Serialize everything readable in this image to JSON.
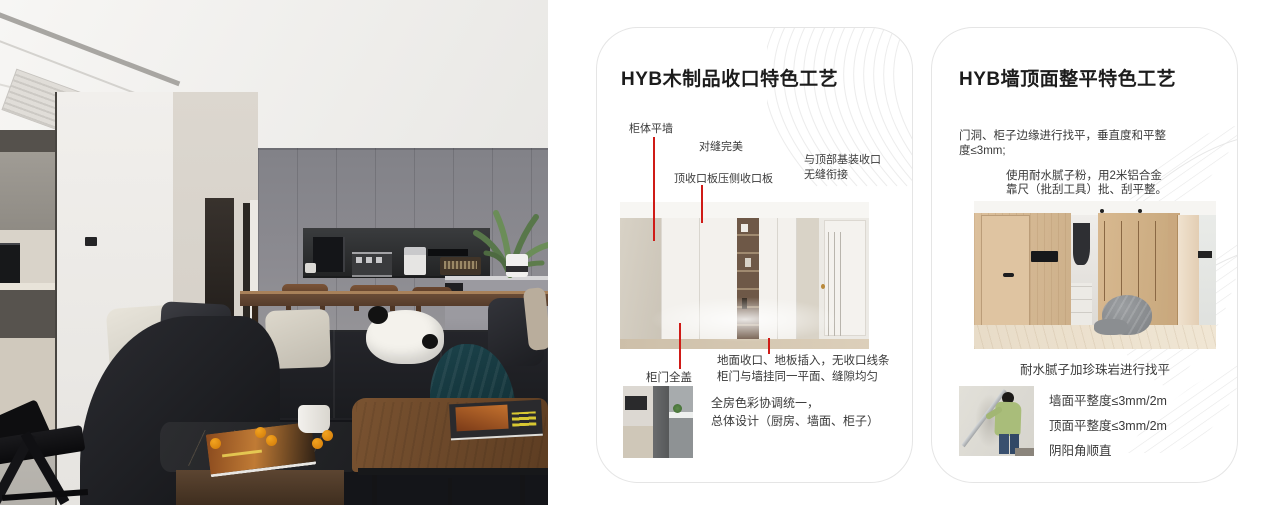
{
  "colors": {
    "annotation_red": "#cf1b17",
    "card_border": "#e5e5e5",
    "text_dark": "#1c1c1c",
    "text_body": "#3a3a3a"
  },
  "card1": {
    "title": "HYB木制品收口特色工艺",
    "label_cabinet_wall": "柜体平墙",
    "label_seam": "对缝完美",
    "label_top_panel": "顶收口板压侧收口板",
    "label_ceiling_1": "与顶部基装收口",
    "label_ceiling_2": "无缝衔接",
    "label_door_cover": "柜门全盖",
    "label_floor_1": "地面收口、地板插入，无收口线条",
    "label_floor_2": "柜门与墙挂同一平面、缝隙均匀",
    "summary_1": "全房色彩协调统一，",
    "summary_2": "总体设计（厨房、墙面、柜子）"
  },
  "card2": {
    "title": "HYB墙顶面整平特色工艺",
    "para1_1": "门洞、柜子边缘进行找平，垂直度和平整",
    "para1_2": "度≤3mm;",
    "para2_1": "使用耐水腻子粉，用2米铝合金",
    "para2_2": "靠尺（批刮工具）批、刮平整。",
    "caption": "耐水腻子加珍珠岩进行找平",
    "spec_1": "墙面平整度≤3mm/2m",
    "spec_2": "顶面平整度≤3mm/2m",
    "spec_3": "阴阳角顺直"
  }
}
